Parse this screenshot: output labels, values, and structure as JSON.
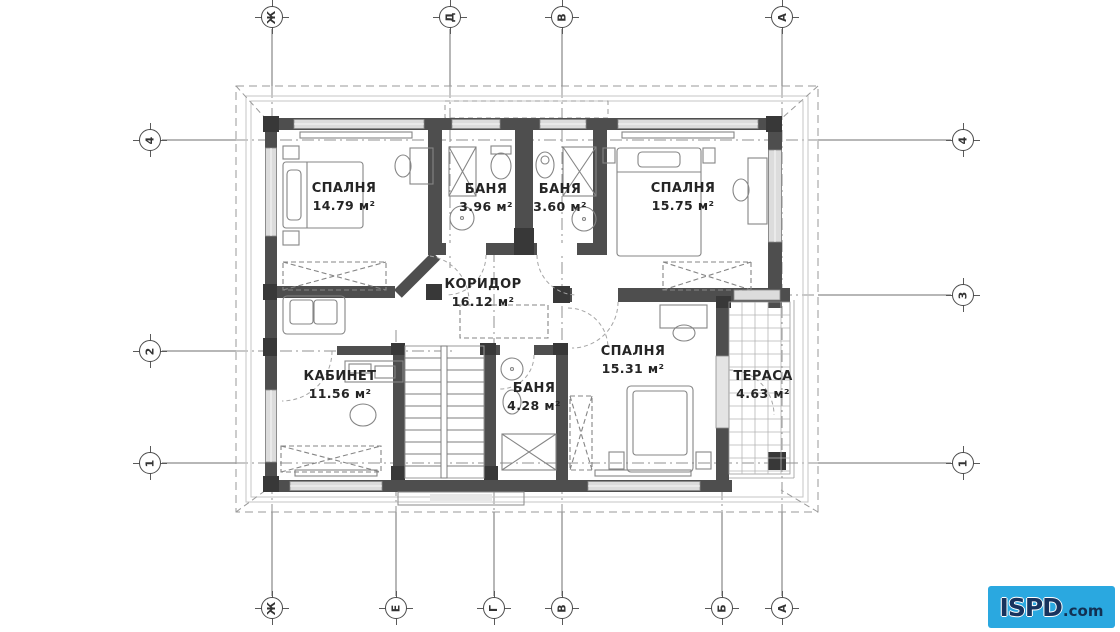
{
  "plan": {
    "type": "architectural-floor-plan",
    "units": "м²",
    "rooms": [
      {
        "id": "bedroom-1",
        "name": "СПАЛНЯ",
        "area": "14.79 м²"
      },
      {
        "id": "bath-1",
        "name": "БАНЯ",
        "area": "3.96 м²"
      },
      {
        "id": "bath-2",
        "name": "БАНЯ",
        "area": "3.60 м²"
      },
      {
        "id": "bedroom-2",
        "name": "СПАЛНЯ",
        "area": "15.75 м²"
      },
      {
        "id": "corridor",
        "name": "КОРИДОР",
        "area": "16.12 м²"
      },
      {
        "id": "office",
        "name": "КАБИНЕТ",
        "area": "11.56 м²"
      },
      {
        "id": "bath-3",
        "name": "БАНЯ",
        "area": "4.28 м²"
      },
      {
        "id": "bedroom-3",
        "name": "СПАЛНЯ",
        "area": "15.31 м²"
      },
      {
        "id": "terrace",
        "name": "ТЕРАСА",
        "area": "4.63 м²"
      }
    ],
    "grid": {
      "top": [
        {
          "label": "Ж"
        },
        {
          "label": "Д"
        },
        {
          "label": "В"
        },
        {
          "label": "А"
        }
      ],
      "bottom": [
        {
          "label": "Ж"
        },
        {
          "label": "Е"
        },
        {
          "label": "Г"
        },
        {
          "label": "В"
        },
        {
          "label": "Б"
        },
        {
          "label": "А"
        }
      ],
      "left": [
        {
          "label": "4"
        },
        {
          "label": "2"
        },
        {
          "label": "1"
        }
      ],
      "right": [
        {
          "label": "4"
        },
        {
          "label": "3"
        },
        {
          "label": "1"
        }
      ]
    }
  },
  "logo": {
    "text": "ISPD",
    "suffix": ".com",
    "background": "#2AA8E0",
    "text_color": "#17335E"
  }
}
